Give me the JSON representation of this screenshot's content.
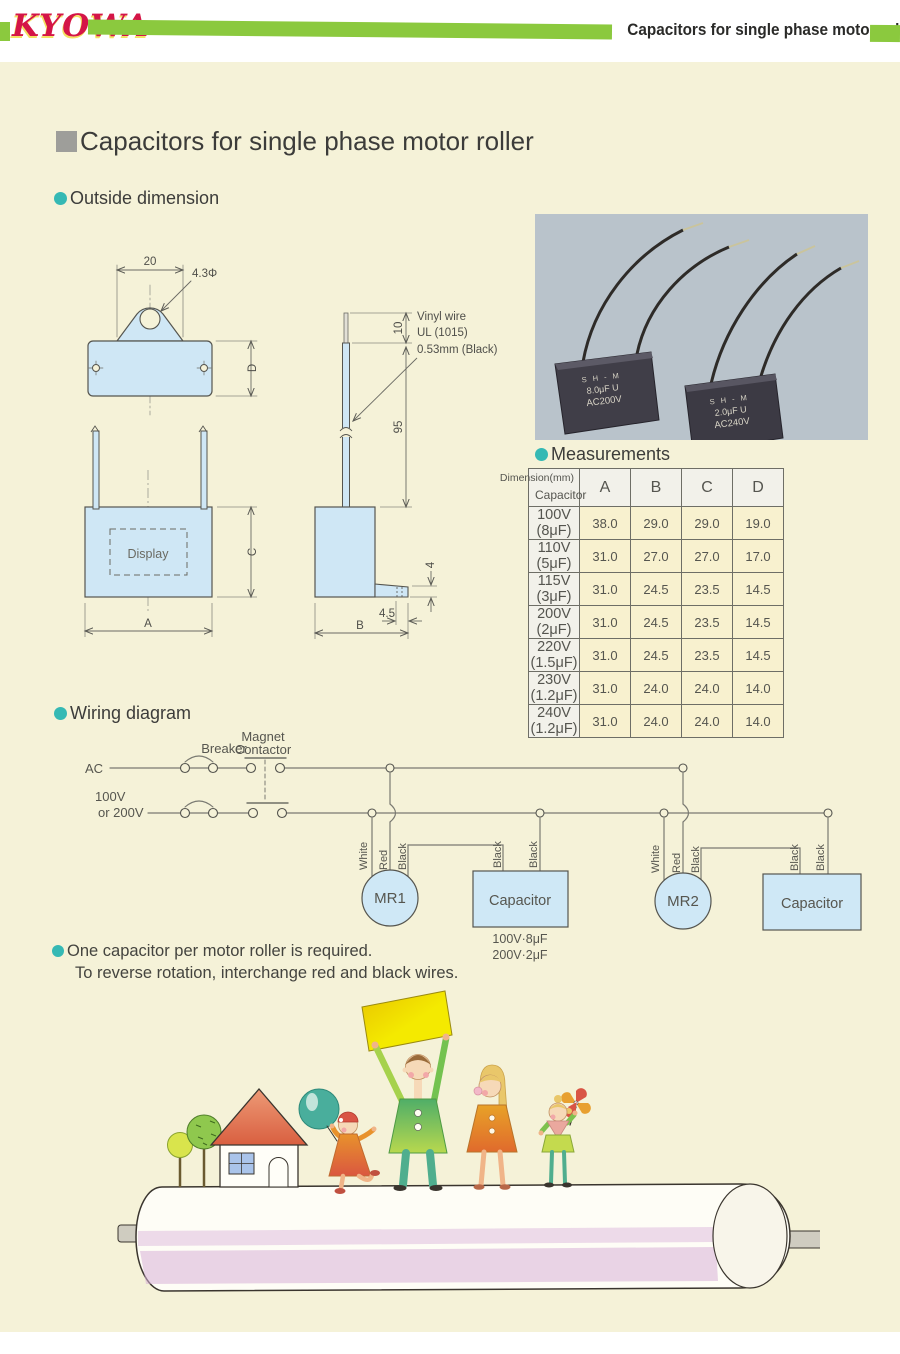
{
  "header": {
    "logo_text": "KYOWA",
    "title": "Capacitors for single phase motor roller"
  },
  "page": {
    "main_title": "Capacitors for single phase motor roller"
  },
  "outside_dimension": {
    "heading": "Outside dimension",
    "top_view": {
      "width_dim": "20",
      "hole_dim": "4.3Φ",
      "height_dim": "D"
    },
    "front_view": {
      "display": "Display",
      "width_dim": "A",
      "height_dim": "C"
    },
    "side_view": {
      "tip_dim": "10",
      "lead_dim": "95",
      "wire_note_line1": "Vinyl wire",
      "wire_note_line2": "UL (1015)",
      "wire_note_line3": "0.53mm (Black)",
      "tab_dim": "4",
      "tab_offset_dim": "4.5",
      "depth_dim": "B"
    }
  },
  "photo": {
    "cap_left": {
      "line1": "S H - M",
      "line2": "8.0μF U",
      "line3": "AC200V"
    },
    "cap_right": {
      "line1": "S H - M",
      "line2": "2.0μF U",
      "line3": "AC240V"
    }
  },
  "measurements": {
    "heading": "Measurements",
    "corner_top": "Dimension(mm)",
    "corner_bottom": "Capacitor",
    "columns": [
      "A",
      "B",
      "C",
      "D"
    ],
    "rows": [
      {
        "capacitor": "100V (8μF)",
        "values": [
          "38.0",
          "29.0",
          "29.0",
          "19.0"
        ]
      },
      {
        "capacitor": "110V (5μF)",
        "values": [
          "31.0",
          "27.0",
          "27.0",
          "17.0"
        ]
      },
      {
        "capacitor": "115V (3μF)",
        "values": [
          "31.0",
          "24.5",
          "23.5",
          "14.5"
        ]
      },
      {
        "capacitor": "200V (2μF)",
        "values": [
          "31.0",
          "24.5",
          "23.5",
          "14.5"
        ]
      },
      {
        "capacitor": "220V (1.5μF)",
        "values": [
          "31.0",
          "24.5",
          "23.5",
          "14.5"
        ]
      },
      {
        "capacitor": "230V (1.2μF)",
        "values": [
          "31.0",
          "24.0",
          "24.0",
          "14.0"
        ]
      },
      {
        "capacitor": "240V (1.2μF)",
        "values": [
          "31.0",
          "24.0",
          "24.0",
          "14.0"
        ]
      }
    ]
  },
  "wiring": {
    "heading": "Wiring diagram",
    "ac": "AC",
    "voltage_line1": "100V",
    "voltage_line2": "or 200V",
    "breaker": "Breaker",
    "magnet_line1": "Magnet",
    "magnet_line2": "Contactor",
    "white": "White",
    "red": "Red",
    "black": "Black",
    "mr1": "MR1",
    "mr2": "MR2",
    "capacitor": "Capacitor",
    "cap_value_line1": "100V·8μF",
    "cap_value_line2": "200V·2μF"
  },
  "notes": {
    "line1": "One capacitor per motor roller is required.",
    "line2": "To reverse rotation, interchange red and black wires."
  },
  "colors": {
    "accent_green": "#8bc93e",
    "logo_red": "#d41547",
    "bullet_teal": "#35b9b4",
    "panel_cream": "#f5f2d8",
    "diagram_blue": "#cfe7f5"
  }
}
